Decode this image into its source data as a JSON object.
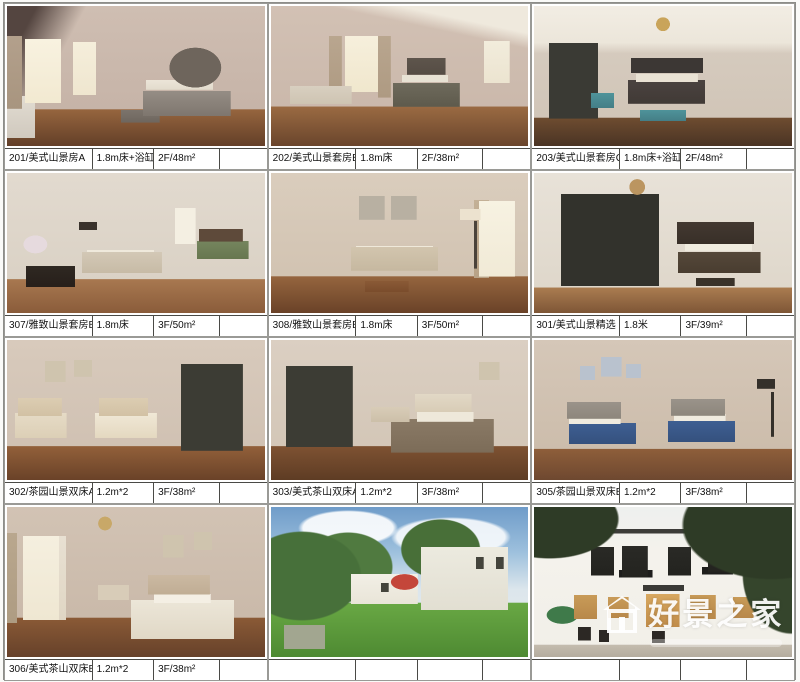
{
  "page": {
    "background": "#fafaf8",
    "accent_border": "#4a4a46"
  },
  "watermark": {
    "text": "好景之家",
    "icon": "house-logo-icon",
    "color": "#ffffff"
  },
  "rooms": [
    {
      "name": "201/美式山景房A",
      "bed": "1.8m床+浴缸",
      "floor_area": "2F/48m²",
      "extra": "",
      "scene": "s201"
    },
    {
      "name": "202/美式山景套房B",
      "bed": "1.8m床",
      "floor_area": "2F/38m²",
      "extra": "",
      "scene": "s202"
    },
    {
      "name": "203/美式山景套房C",
      "bed": "1.8m床+浴缸",
      "floor_area": "2F/48m²",
      "extra": "",
      "scene": "s203"
    },
    {
      "name": "307/雅致山景套房B",
      "bed": "1.8m床",
      "floor_area": "3F/50m²",
      "extra": "",
      "scene": "s307"
    },
    {
      "name": "308/雅致山景套房B",
      "bed": "1.8m床",
      "floor_area": "3F/50m²",
      "extra": "",
      "scene": "s308"
    },
    {
      "name": "301/美式山景精选",
      "bed": "1.8米",
      "floor_area": "3F/39m²",
      "extra": "",
      "scene": "s301"
    },
    {
      "name": "302/茶园山景双床A",
      "bed": "1.2m*2",
      "floor_area": "3F/38m²",
      "extra": "",
      "scene": "s302"
    },
    {
      "name": "303/美式茶山双床A",
      "bed": "1.2m*2",
      "floor_area": "3F/38m²",
      "extra": "",
      "scene": "s303"
    },
    {
      "name": "305/茶园山景双床B",
      "bed": "1.2m*2",
      "floor_area": "3F/38m²",
      "extra": "",
      "scene": "s305"
    },
    {
      "name": "306/美式茶山双床B",
      "bed": "1.2m*2",
      "floor_area": "3F/38m²",
      "extra": "",
      "scene": "s306"
    },
    {
      "name": "",
      "bed": "",
      "floor_area": "",
      "extra": "",
      "scene": "garden"
    },
    {
      "name": "",
      "bed": "",
      "floor_area": "",
      "extra": "",
      "scene": "facade"
    }
  ]
}
